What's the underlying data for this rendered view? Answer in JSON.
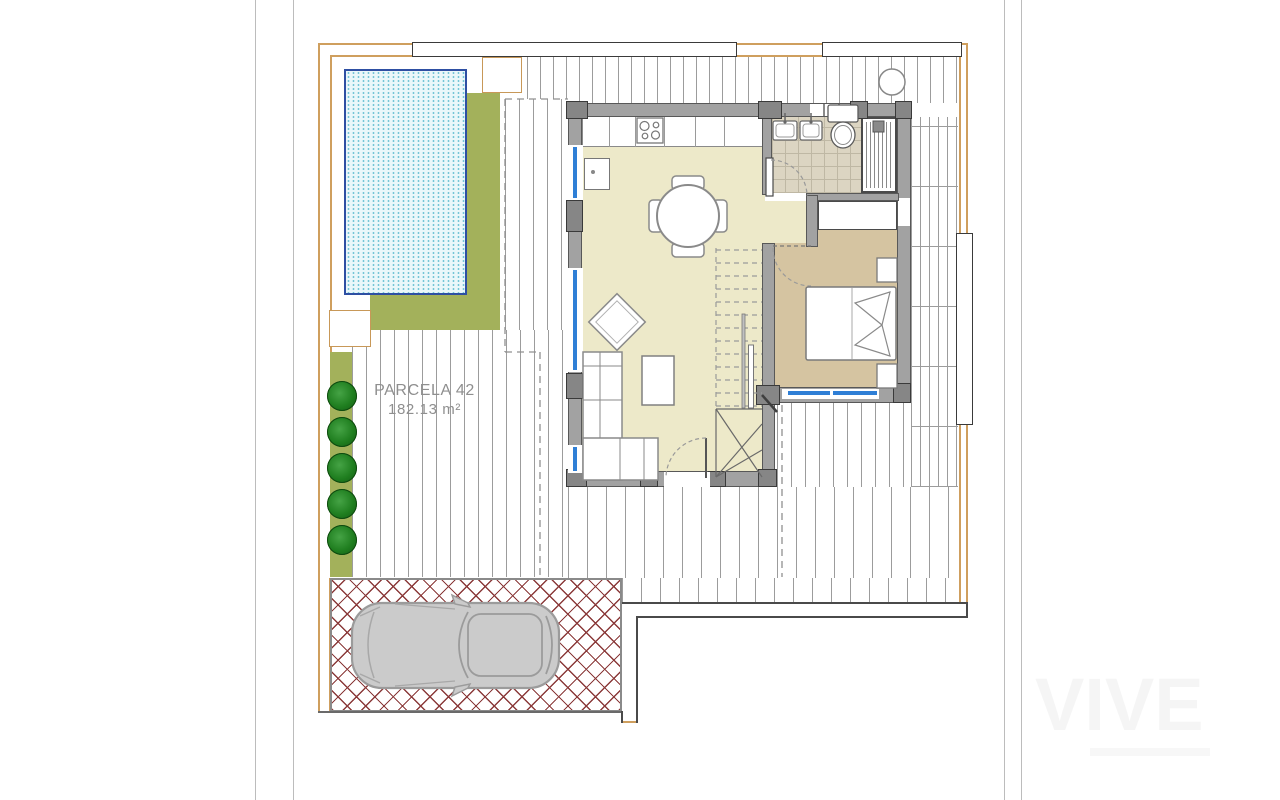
{
  "plan": {
    "parcel_label": "PARCELA 42",
    "parcel_area": "182.13 m²",
    "watermark_text": "VIVE"
  },
  "colors": {
    "plot_boundary_tan": "#cf9f5e",
    "lawn_green": "#a3b15b",
    "shrub_green": "#1f7e1f",
    "pool_fill": "#eaf7fa",
    "pool_border": "#2e4fa3",
    "pool_dots": "#74c5d6",
    "deck_line_gray": "#9c9c9c",
    "wall_gray": "#a2a2a2",
    "pillar_gray": "#868686",
    "window_blue": "#2f7fd6",
    "floor_cream": "#ede9c9",
    "floor_bedroom_tan": "#d5c4a1",
    "bathroom_tile": "#dcd5c2",
    "driveway_brick_red": "#8b3a3a",
    "car_gray": "#cbcbcb",
    "label_gray": "#8f8f8f"
  },
  "features": [
    "swimming-pool",
    "lawn",
    "hedge-shrubs",
    "timber-deck-terrace",
    "parcel-label",
    "kitchen-counter",
    "stove",
    "kitchen-sink",
    "dining-table",
    "chairs",
    "sofa",
    "coffee-table",
    "armchair",
    "staircase",
    "entrance-door",
    "bathroom",
    "double-sink-vanity",
    "toilet",
    "shower",
    "bedroom",
    "double-bed",
    "nightstands",
    "wardrobe",
    "driveway-herringbone",
    "car",
    "sidewalk",
    "pergola",
    "planters",
    "watermark"
  ]
}
